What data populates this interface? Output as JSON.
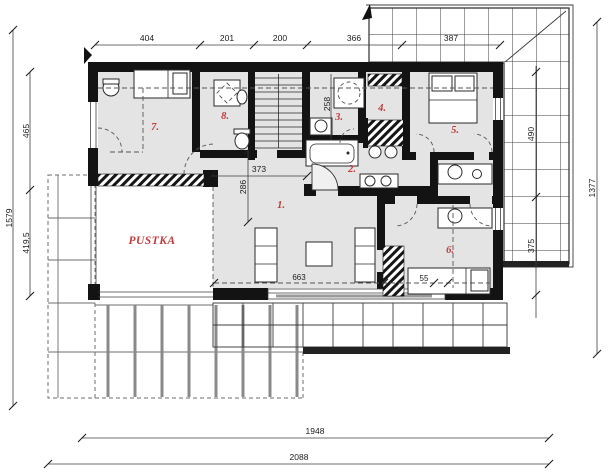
{
  "labels": {
    "void": "PUSTKA"
  },
  "rooms": {
    "r1": "1.",
    "r2": "2.",
    "r3": "3.",
    "r4": "4.",
    "r5": "5.",
    "r6": "6.",
    "r7": "7.",
    "r8": "8."
  },
  "dimensions": {
    "top": {
      "seg1": "404",
      "seg2": "201",
      "seg3": "200",
      "seg4": "366",
      "seg5": "387"
    },
    "left": {
      "total": "1579",
      "upper": "465",
      "lower": "419,5"
    },
    "right": {
      "total": "1377"
    },
    "roof_right": {
      "upper": "490",
      "lower": "375"
    },
    "bottom": {
      "inner": "1948",
      "outer": "2088"
    },
    "interior": {
      "hall_width": "373",
      "hall_depth": "286",
      "bath_depth": "258",
      "opening": "663",
      "bed_width": "55"
    }
  },
  "colors": {
    "accent_red": "#c23a3a",
    "wall_black": "#131313",
    "floor_gray": "#e4e4e4",
    "line_gray": "#555555"
  }
}
